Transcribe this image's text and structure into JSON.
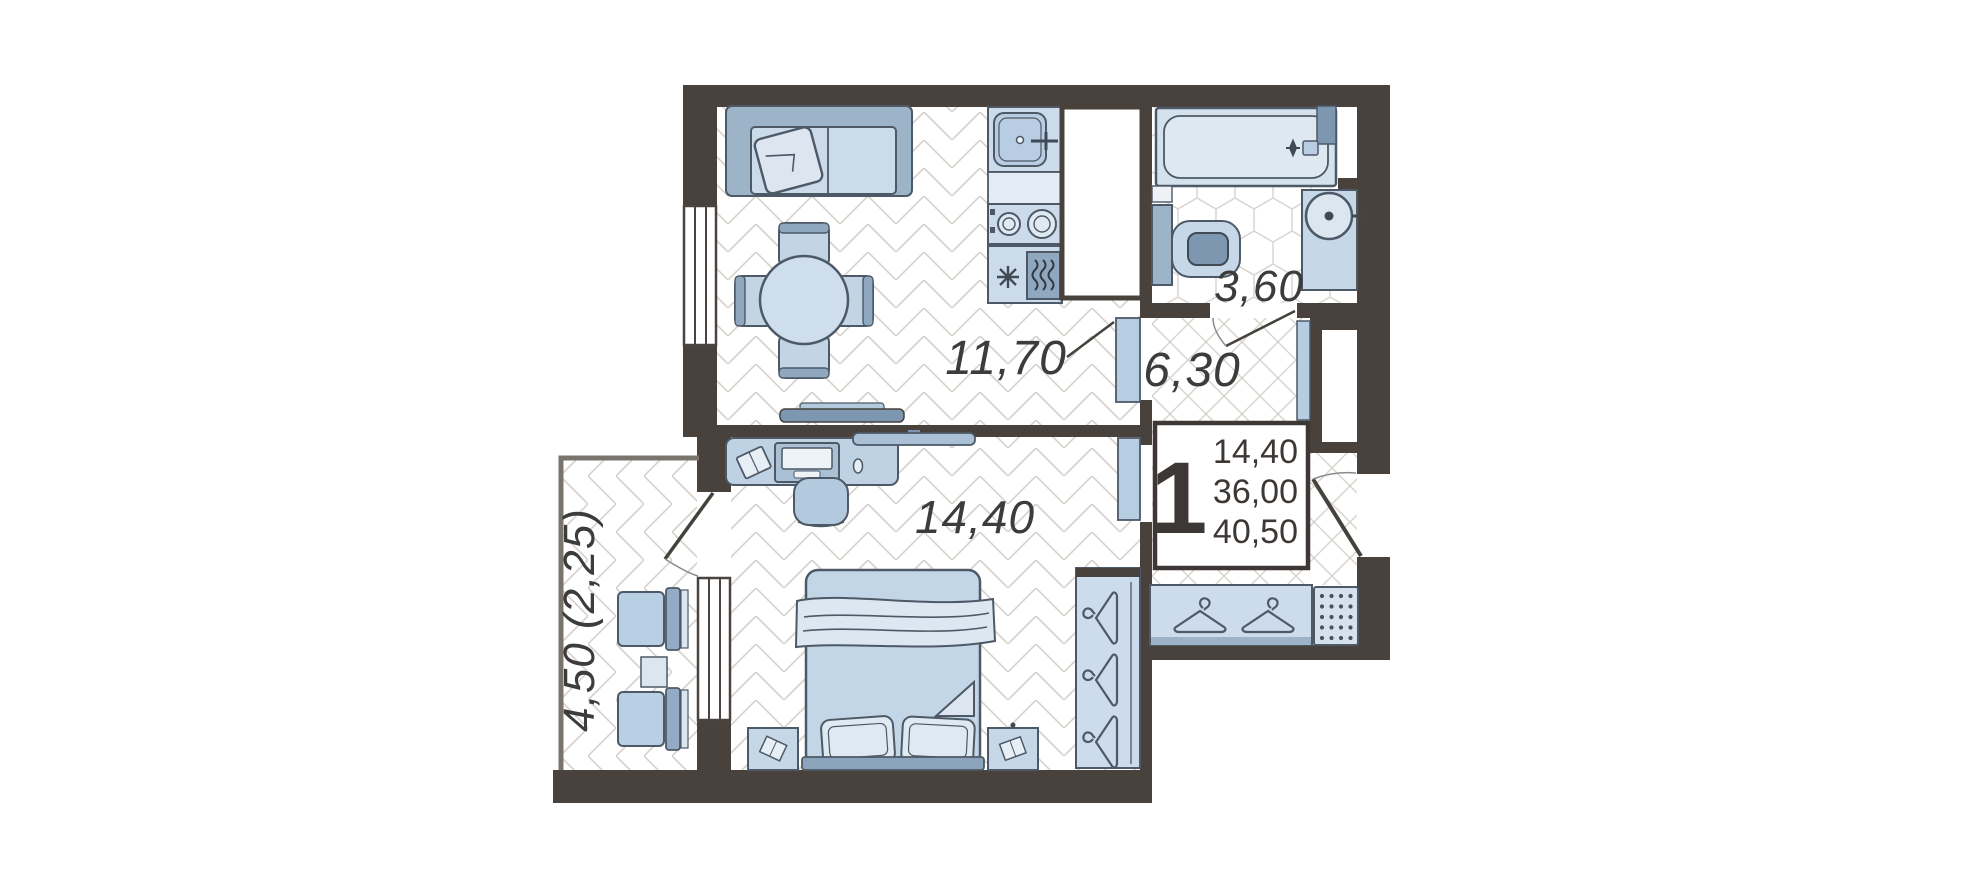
{
  "page": {
    "background_color": "#ffffff"
  },
  "floor_plan": {
    "kind": "1-room apartment floor plan",
    "colors": {
      "wall": "#49413b",
      "outline": "#4d5966",
      "furniture_light": "#ccdbe9",
      "furniture_mid": "#9db3c8",
      "furniture_dark": "#7e97b1",
      "floor_pattern_line": "#d5d2cc",
      "label_text": "#3c3c3c",
      "door_leaf": "#b7cee2",
      "info_box_border": "#3d3835"
    },
    "rooms": {
      "living_kitchen": {
        "area_label": "11,70"
      },
      "hall": {
        "area_label": "6,30"
      },
      "bathroom": {
        "area_label": "3,60"
      },
      "bedroom": {
        "area_label": "14,40"
      },
      "balcony": {
        "area_label": "4,50 (2,25)"
      }
    },
    "info_box": {
      "rooms_count": "1",
      "area_line_1": "14,40",
      "area_line_2": "36,00",
      "area_line_3": "40,50"
    },
    "icons": {
      "hanger": "clothes-hanger-icon",
      "snowflake": "fridge-snowflake-icon",
      "oven": "oven-waves-icon",
      "burner": "stove-burner-icon",
      "faucet": "faucet-icon",
      "doormat": "doormat-dots-icon"
    }
  }
}
